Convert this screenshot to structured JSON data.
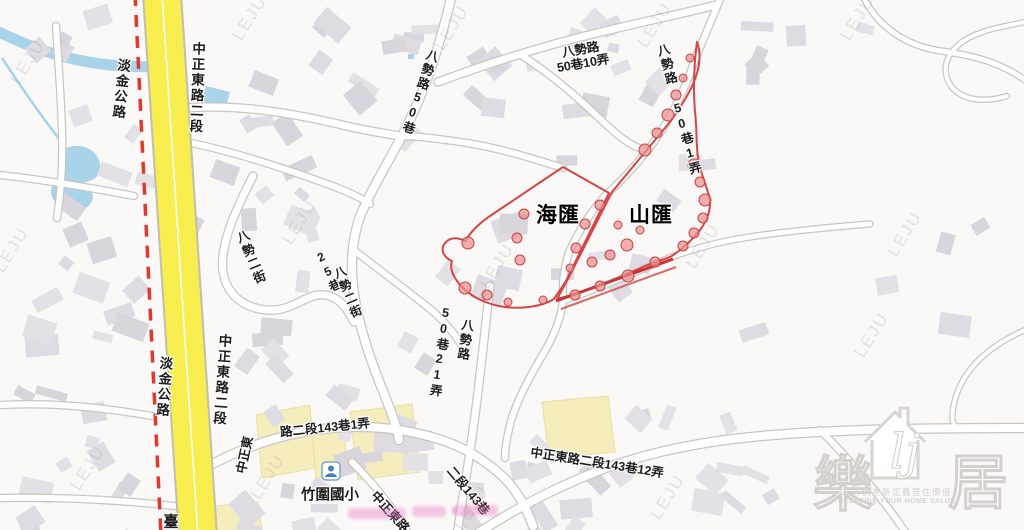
{
  "map": {
    "watermark_text": "LEJU",
    "communities": {
      "left": "海匯",
      "right": "山匯"
    },
    "roads": {
      "zhongzheng_top": "中正東路二段",
      "zhongzheng_bottom": "中正東路二段",
      "danjin_top": "淡金公路",
      "danjin_bottom": "淡金公路",
      "tai_partial": "臺",
      "bashi_50_10_line1": "八勢路",
      "bashi_50_10_line2": "50巷10弄",
      "bashi_50": "八勢路50巷",
      "bashi_50_1": "八勢路 50巷1弄",
      "bashi_2_a": "八勢二街",
      "bashi_2_b": "八勢二街",
      "lane_25": "25巷",
      "lane_50_21": "50巷21弄",
      "bashi_road": "八勢路",
      "zz143_1_part1": "中正東",
      "zz143_1_part2": "路二段143巷1弄",
      "zz_diag_a": "中正東路",
      "zz_diag_b": "二段143巷",
      "zz143_12": "中正東路二段143巷12弄"
    },
    "poi": {
      "school": "竹圍國小"
    }
  },
  "logo": {
    "char_left": "樂",
    "char_right": "居",
    "monogram": "lj",
    "slogan_zh": "幫人們重新定義居住價值",
    "slogan_en": "REDEFINE YOUR HOME VALUE"
  },
  "colors": {
    "accent_red": "#d64545",
    "road_yellow": "#f8ee4f",
    "water_blue": "#a8d3e8",
    "school_yellow": "#f6edbd"
  }
}
